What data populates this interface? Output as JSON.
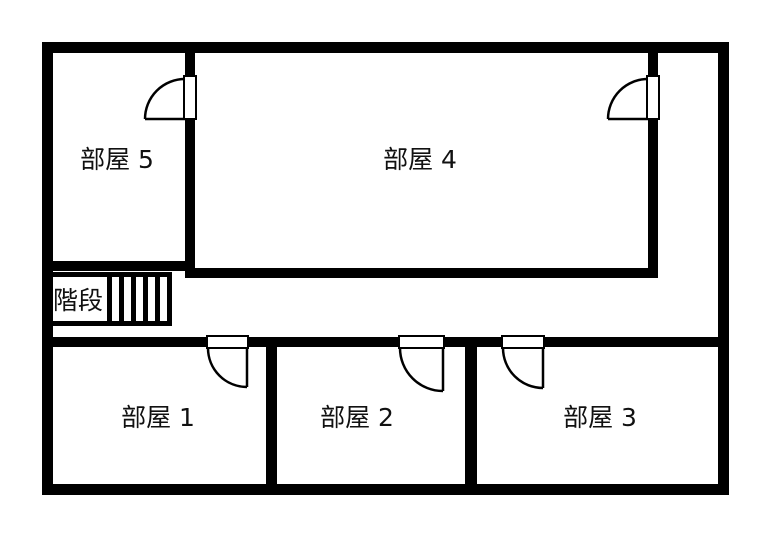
{
  "floor_plan": {
    "background_color": "#ffffff",
    "wall_color": "#000000",
    "label_color": "#111111",
    "rooms": [
      {
        "id": "room-1",
        "label": "部屋 1"
      },
      {
        "id": "room-2",
        "label": "部屋 2"
      },
      {
        "id": "room-3",
        "label": "部屋 3"
      },
      {
        "id": "room-4",
        "label": "部屋 4"
      },
      {
        "id": "room-5",
        "label": "部屋 5"
      }
    ],
    "stairs": {
      "label": "階段"
    }
  }
}
